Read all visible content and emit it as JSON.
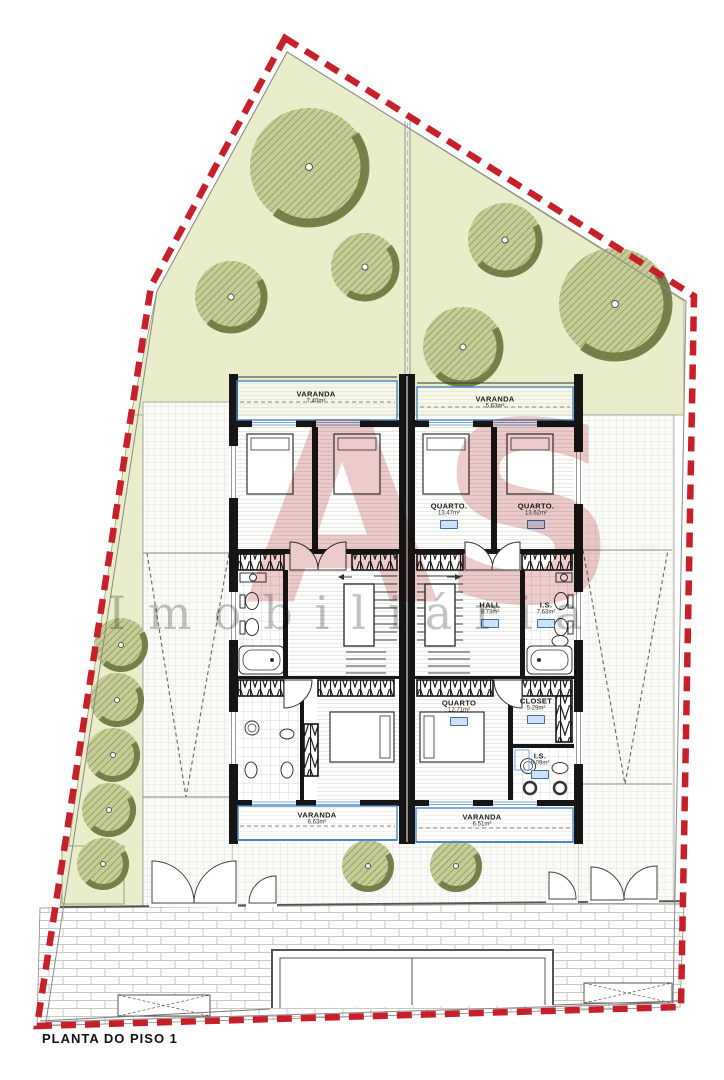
{
  "title": "PLANTA DO PISO 1",
  "watermark": {
    "logo": "AS",
    "text": "Imobiliária"
  },
  "rooms": {
    "varanda_tl": {
      "name": "VARANDA",
      "area": "7.40m²"
    },
    "varanda_tr": {
      "name": "VARANDA",
      "area": "5.63m²"
    },
    "quarto_top_left": {
      "name": "QUARTO.",
      "area": "13.47m²"
    },
    "quarto_top_right": {
      "name": "QUARTO.",
      "area": "13.62m²"
    },
    "hall": {
      "name": "HALL",
      "area": "8.73m²"
    },
    "is_mid": {
      "name": "I.S.",
      "area": "7.63m²"
    },
    "quarto_low": {
      "name": "QUARTO",
      "area": "12.71m²"
    },
    "closet": {
      "name": "CLOSET",
      "area": "5.29m²"
    },
    "is_low": {
      "name": "I.S.",
      "area": "6.09m²"
    },
    "varanda_bl": {
      "name": "VARANDA",
      "area": "6.63m²"
    },
    "varanda_br": {
      "name": "VARANDA",
      "area": "6.51m²"
    }
  },
  "colors": {
    "boundary_red": "#c8202a",
    "lawn_green": "#e9edca",
    "tree_green": "#c6cc96",
    "tree_shadow": "#6d7840",
    "wall_black": "#161616",
    "balcony_blue": "#4a86c8",
    "badge_blue": "#3d6ea8",
    "watermark_red": "rgba(197,84,84,0.30)",
    "watermark_gray": "rgba(105,105,105,0.40)"
  }
}
